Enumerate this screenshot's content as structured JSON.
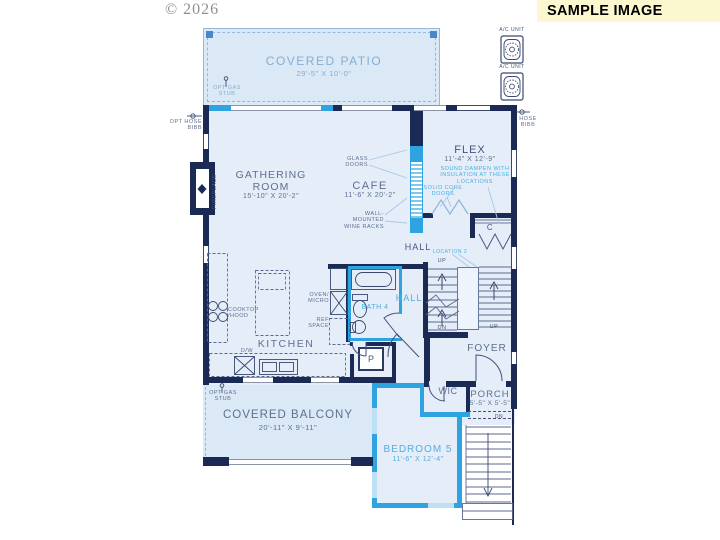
{
  "meta": {
    "copyright": "© 2026",
    "banner": "SAMPLE IMAGE"
  },
  "hvac": {
    "ac_unit_1": "A/C UNIT",
    "ac_unit_2": "A/C UNIT"
  },
  "rooms": {
    "covered_patio": {
      "name": "COVERED PATIO",
      "dims": "29'-5\" X 10'-0\""
    },
    "gathering_room": {
      "name": "GATHERING\nROOM",
      "dims": "15'-10\" X 20'-2\""
    },
    "cafe": {
      "name": "CAFE",
      "dims": "11'-6\" X 20'-2\""
    },
    "flex": {
      "name": "FLEX",
      "dims": "11'-4\" X 12'-9\""
    },
    "kitchen": {
      "name": "KITCHEN"
    },
    "hall_upper": {
      "name": "HALL"
    },
    "hall_lower": {
      "name": "HALL"
    },
    "bath4": {
      "name": "BATH 4"
    },
    "pantry": {
      "name": "P"
    },
    "closet": {
      "name": "C"
    },
    "foyer": {
      "name": "FOYER"
    },
    "wic": {
      "name": "WIC"
    },
    "porch": {
      "name": "PORCH",
      "dims": "5'-5\" X 5'-5\""
    },
    "covered_balcony": {
      "name": "COVERED BALCONY",
      "dims": "20'-11\" X 9'-11\""
    },
    "bedroom5": {
      "name": "BEDROOM 5",
      "dims": "11'-6\" X 12'-4\""
    }
  },
  "annotations": {
    "patio_gas_stub": "OPT GAS\nSTUB",
    "balcony_gas_stub": "OPT GAS\nSTUB",
    "opt_hose_bibb": "OPT HOSE\nBIBB",
    "hose_bibb": "HOSE\nBIBB",
    "fireplace": "FIREPLACE",
    "glass_doors": "GLASS\nDOORS",
    "wine_racks": "WALL-MOUNTED\nWINE RACKS",
    "sound_dampen": "SOUND DAMPEN WITH\nINSULATION AT THESE\nLOCATIONS",
    "solid_core_doors": "SOLID CORE\nDOORS",
    "location_2": "LOCATION 2",
    "cooktop_hood": "COOKTOP\n/HOOD",
    "oven_micro": "OVEN/\nMICRO",
    "ref_space": "REF\nSPACE",
    "dishwasher": "D/W",
    "stair_up_1": "UP",
    "stair_dn": "DN",
    "stair_up_2": "UP",
    "porch_dn": "DN"
  },
  "colors": {
    "wall_navy": "#1b2a55",
    "highlight_cyan": "#2ea3df",
    "floor_fill": "#e4edf8",
    "patio_fill": "#dbe8f6",
    "label_slate": "#5e7090",
    "label_cyan": "#49b0e4",
    "label_light_blue": "#86aed3",
    "banner_bg": "#fbf8d0"
  }
}
